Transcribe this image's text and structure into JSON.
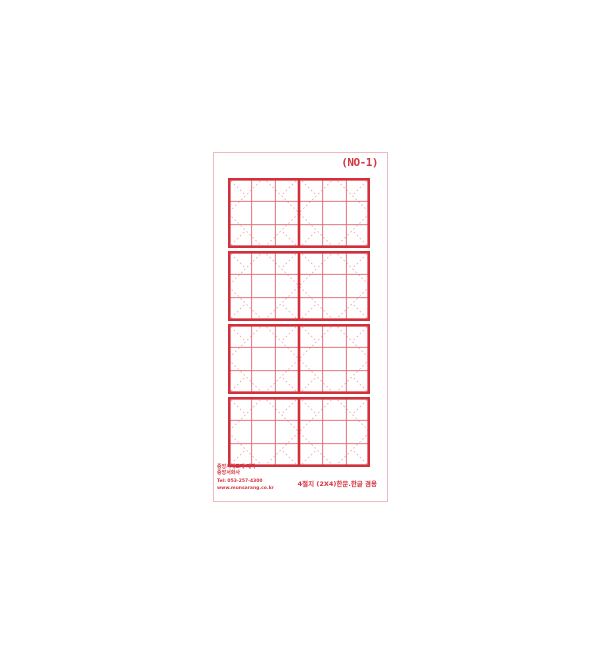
{
  "page": {
    "background": "#ffffff"
  },
  "paper": {
    "label": "(NO-1)",
    "border_color": "#f0b9bd",
    "grid": {
      "rows": 4,
      "columns": 2,
      "subdivisions": 3,
      "thick_color": "#d22f3a",
      "thin_color": "#e0656d",
      "dash_color": "#f0a6ab"
    },
    "footer_left": {
      "line1": "중앙서예교재 제작",
      "line2": "중앙서화사",
      "line3": "Tel: 053-257-4300",
      "line4": "www.munsarang.co.kr"
    },
    "footer_right": "4절지 (2X4)한문.한글 겸용",
    "text_color": "#d43540"
  }
}
